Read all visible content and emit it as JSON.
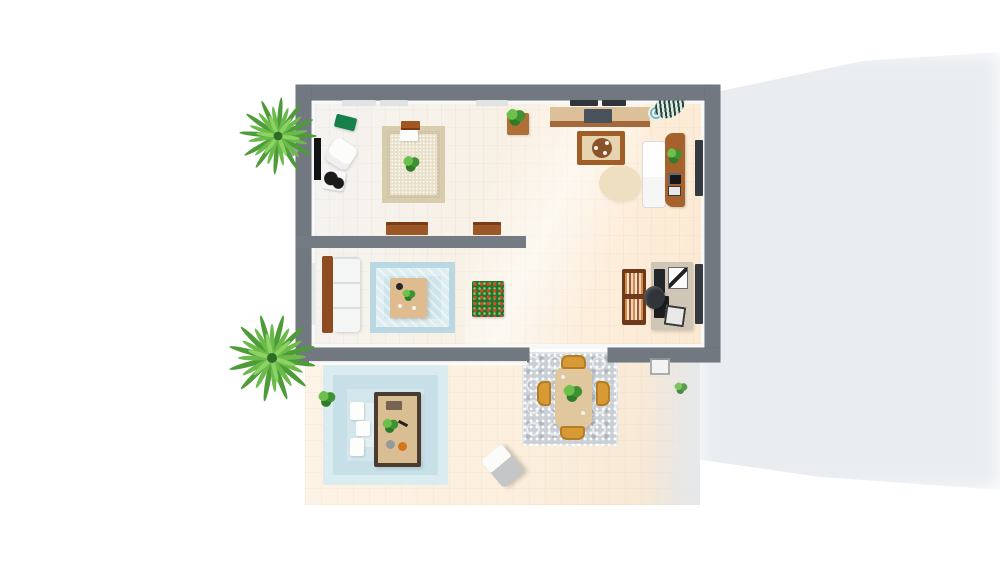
{
  "scene": {
    "title": "3D floor plan — top-down render",
    "view": "top-down isometric render of a two-room flat with patio",
    "background": "#ffffff"
  },
  "palette": {
    "wall_gray": "#72787f",
    "inner_wall_white": "#f7f9f9",
    "floor_warm": "#fbeedd",
    "patio_floor": "#fcf0e1",
    "pool_blue": "#cfe4ea",
    "rug_blue": "#cde4ea",
    "rug_beige": "#e9e0ca",
    "rug_gray_ornate": "#c9cfd5",
    "wood_brown": "#9c5a28",
    "plant_green": "#54a83d",
    "bench_green": "#15804a",
    "chair_mustard": "#d79a35",
    "cast_shadow": "#e8ecf1",
    "cooktop_gray": "#49525a",
    "tv_black": "#101214"
  },
  "labels": {
    "scene": "3D floor plan top view",
    "shadow": "Building cast shadow",
    "building": "Apartment building",
    "living_room": "Living room with rug, sofa and armchair",
    "kitchen": "Kitchen and dining area",
    "middle_room": "Second lounge and home office",
    "patio": "Outdoor patio",
    "palm_top": "Palm plant (north-west)",
    "palm_bottom": "Palm plant (south-west)",
    "green_bench": "Green bench",
    "armchair": "White armchair",
    "ottoman": "Cow-print ottoman",
    "tv": "Wall TV panel",
    "living_rug": "Beige area rug",
    "living_sofa": "Sofa console",
    "coffee_table_white": "White coffee table",
    "rug_plant": "Potted plant on rug",
    "wall_console_large": "Wooden console",
    "wall_console_small": "Wooden side table",
    "plant_stand": "Plant stand",
    "kitchen_counter": "Kitchen counter with cooktop",
    "kitchen_island": "Kitchen island",
    "round_rug": "Round beige rug",
    "fridge": "Refrigerator",
    "shelf_column": "Wooden shelf column",
    "striped_plant": "Striped-leaf plant in teal pot",
    "window": "Window",
    "sofa_mid": "White sofa with wooden back",
    "blue_rug": "Light blue patterned rug",
    "coffee_table_mid": "Wooden coffee table",
    "flower_bed": "Indoor flower planter",
    "bookshelf": "Bookshelf",
    "desk": "Office desk with monitor",
    "office_chair": "Black office chair",
    "pool_mat": "Layered blue patio mat",
    "cube_seat": "White cube seat",
    "patio_table": "Patio wooden table",
    "dining_rug": "Gray ornate patio rug",
    "dining_table": "Patio dining table",
    "dining_chair": "Mustard dining chair",
    "lounge_chair": "Patio lounge chair",
    "threshold": "Door threshold step",
    "small_plant": "Small plant"
  }
}
